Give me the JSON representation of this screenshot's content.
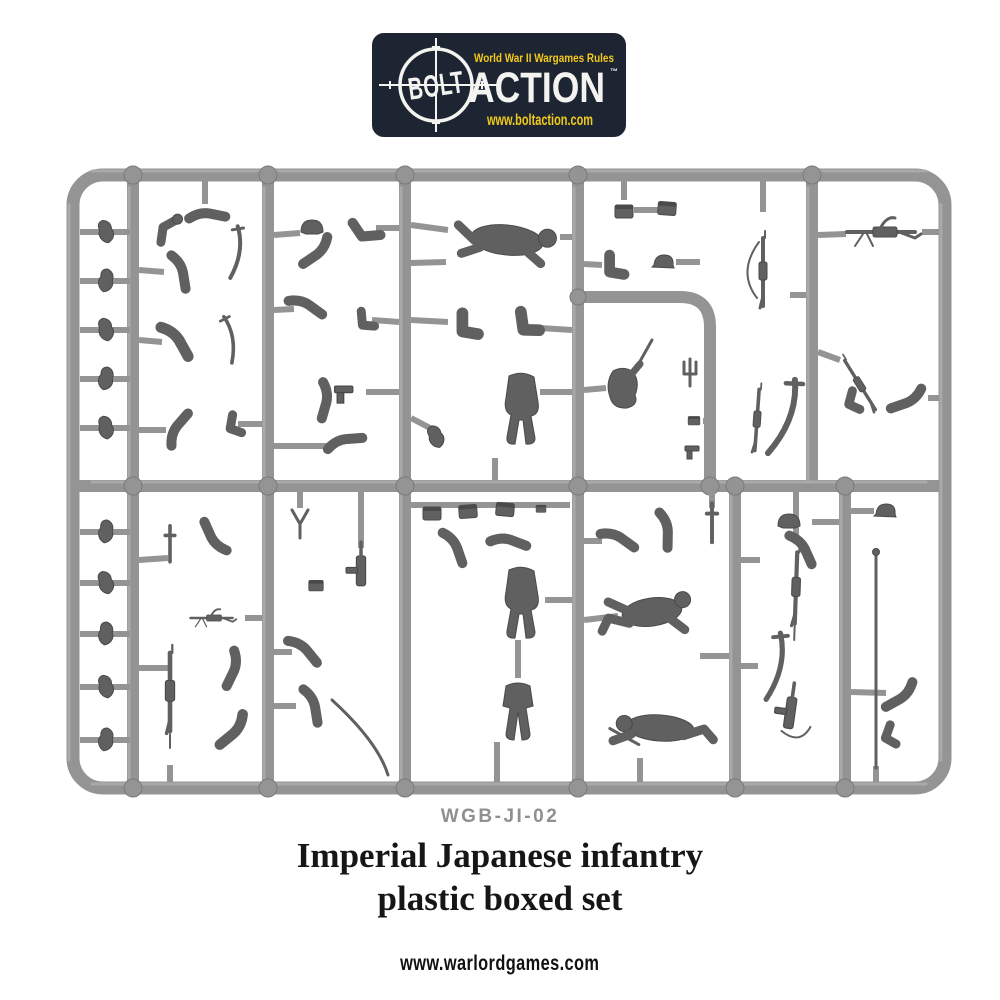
{
  "colors": {
    "page_bg": "#ffffff",
    "logo_navy": "#1d2533",
    "logo_yellow": "#f2c91c",
    "logo_white": "#f3f3f0",
    "sprue_gray": "#949494",
    "sprue_edge": "#7a7a7a",
    "sprue_hi": "#adadad",
    "part_gray": "#606060",
    "part_edge": "#4a4a4a",
    "code_gray": "#8f8f8f",
    "title_black": "#161616"
  },
  "logo": {
    "tagline": "World War II Wargames Rules",
    "brand_left": "BOLT",
    "brand_right": "ACTION",
    "trademark": "™",
    "url": "www.boltaction.com"
  },
  "product": {
    "code": "WGB-JI-02",
    "title_line1": "Imperial Japanese infantry",
    "title_line2": "plastic boxed set"
  },
  "footer": {
    "url": "www.warlordgames.com"
  }
}
